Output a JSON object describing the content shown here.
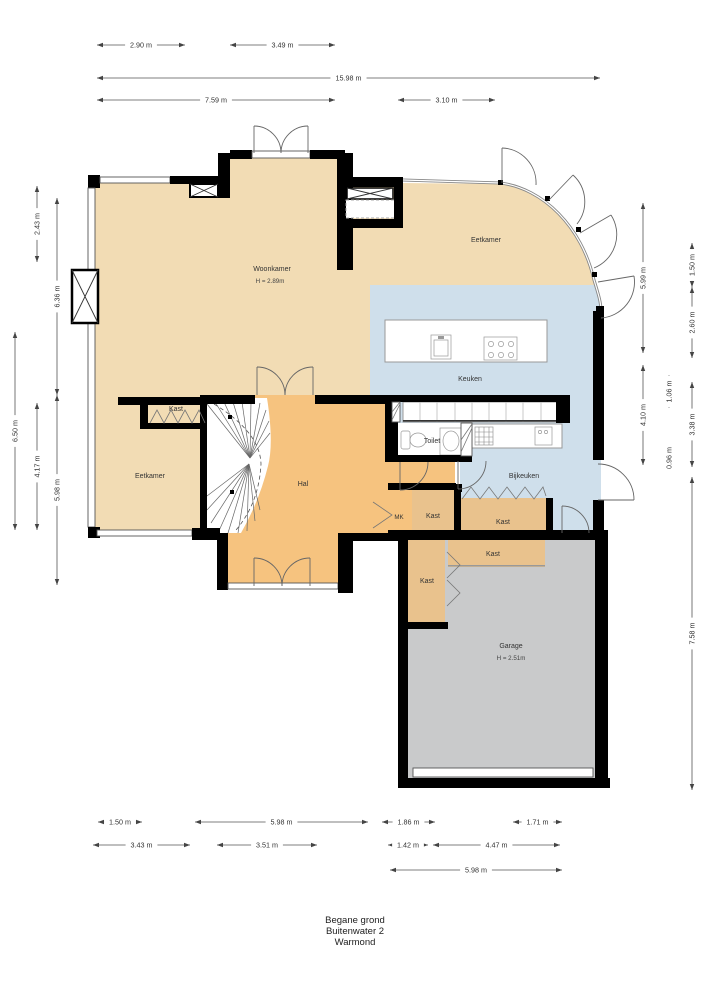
{
  "title": {
    "line1": "Begane grond",
    "line2": "Buitenwater 2",
    "line3": "Warmond"
  },
  "rooms": {
    "woonkamer": {
      "label": "Woonkamer",
      "height": "H = 2.89m"
    },
    "eetkamer_top": {
      "label": "Eetkamer"
    },
    "keuken": {
      "label": "Keuken"
    },
    "eetkamer_left": {
      "label": "Eetkamer"
    },
    "hal": {
      "label": "Hal"
    },
    "toilet": {
      "label": "Toilet"
    },
    "bijkeuken": {
      "label": "Bijkeuken"
    },
    "mk": {
      "label": "MK"
    },
    "kast_eetkamer": {
      "label": "Kast"
    },
    "kast_vestibule": {
      "label": "Kast"
    },
    "kast_bijkeuken": {
      "label": "Kast"
    },
    "kast_garage_top": {
      "label": "Kast"
    },
    "kast_garage_left": {
      "label": "Kast"
    },
    "garage": {
      "label": "Garage",
      "height": "H = 2.51m"
    }
  },
  "dimensions": {
    "top": [
      "2.90 m",
      "3.49 m",
      "15.98 m",
      "7.59 m",
      "3.10 m"
    ],
    "left": [
      "2.43 m",
      "6.36 m",
      "6.50 m",
      "4.17 m",
      "5.98 m"
    ],
    "right": [
      "5.99 m",
      "4.10 m",
      "1.06 m",
      "0.96 m",
      "1.50 m",
      "2.60 m",
      "3.38 m",
      "7.58 m"
    ],
    "bottom": [
      "1.50 m",
      "5.98 m",
      "1.86 m",
      "1.71 m",
      "3.43 m",
      "3.51 m",
      "1.42 m",
      "4.47 m",
      "5.98 m"
    ]
  },
  "colors": {
    "floor_living": "#f2dcb4",
    "floor_hall": "#f6c37f",
    "floor_kitchen": "#cfdfeb",
    "floor_closet": "#e9c28d",
    "floor_garage": "#c9cacb",
    "walls": "#000000"
  }
}
